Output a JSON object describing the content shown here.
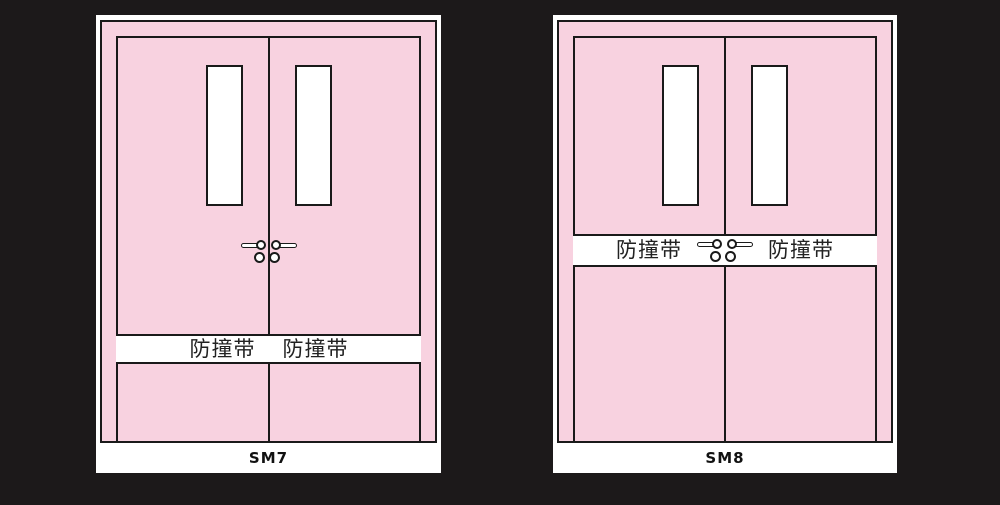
{
  "page": {
    "background_color": "#1c191a"
  },
  "colors": {
    "door_pink": "#f8d2e0",
    "outline_black": "#1a1a1a",
    "card_white": "#ffffff"
  },
  "panels": [
    {
      "caption": "SM7",
      "band": {
        "left_label": "防撞带",
        "right_label": "防撞带",
        "position_note": "lower third of door"
      }
    },
    {
      "caption": "SM8",
      "band": {
        "left_label": "防撞带",
        "right_label": "防撞带",
        "position_note": "mid-height at handles"
      }
    }
  ]
}
